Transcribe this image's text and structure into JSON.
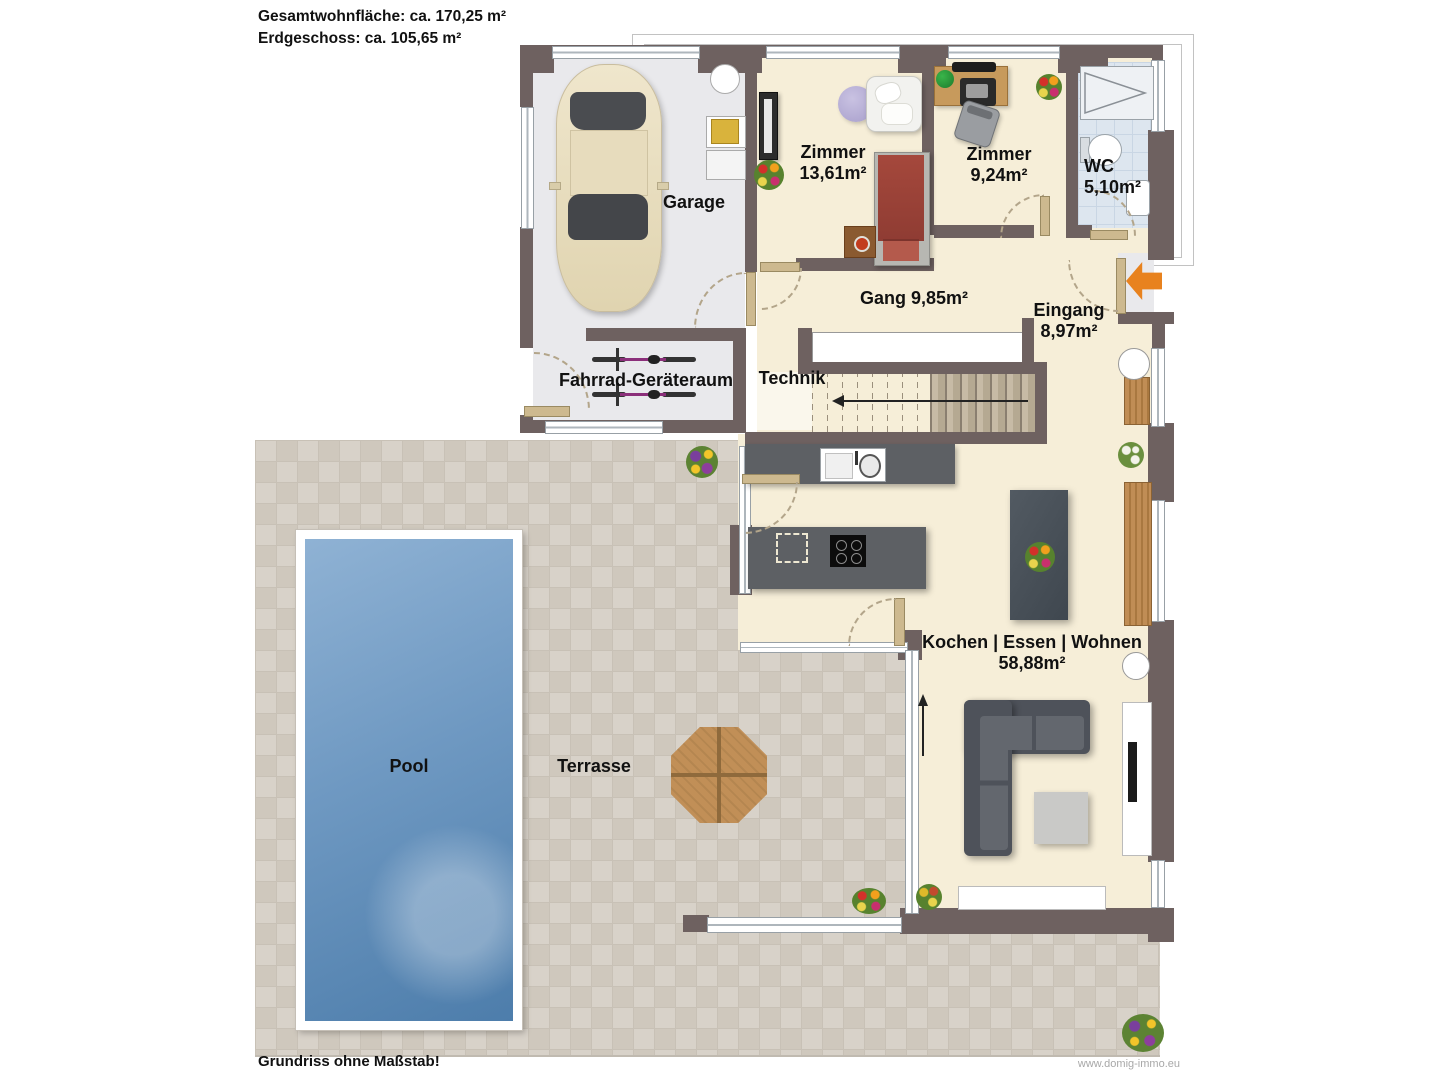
{
  "header": {
    "total_area": "Gesamtwohnfläche: ca. 170,25 m²",
    "ground_floor": "Erdgeschoss: ca. 105,65 m²"
  },
  "rooms": {
    "garage": {
      "label": "Garage"
    },
    "zimmer1": {
      "label": "Zimmer",
      "area": "13,61m²"
    },
    "zimmer2": {
      "label": "Zimmer",
      "area": "9,24m²"
    },
    "wc": {
      "label": "WC",
      "area": "5,10m²"
    },
    "gang": {
      "label": "Gang 9,85m²"
    },
    "eingang": {
      "label": "Eingang",
      "area": "8,97m²"
    },
    "technik": {
      "label": "Technik"
    },
    "fahrrad": {
      "label": "Fahrrad-Geräteraum"
    },
    "wohnen": {
      "label": "Kochen | Essen | Wohnen",
      "area": "58,88m²"
    },
    "pool": {
      "label": "Pool"
    },
    "terrasse": {
      "label": "Terrasse"
    }
  },
  "footer": {
    "note": "Grundriss ohne Maßstab!",
    "website": "www.domig-immo.eu"
  },
  "colors": {
    "wall": "#6e6160",
    "floor_living": "#f6eed8",
    "floor_garage": "#e9e9ec",
    "floor_wc": "#dde6ef",
    "terrace_tile": "#d8d2c9",
    "pool": "#5d8cba",
    "entrance_arrow": "#e8821e",
    "wood": "#c08d55",
    "furniture_dark": "#575b62"
  }
}
